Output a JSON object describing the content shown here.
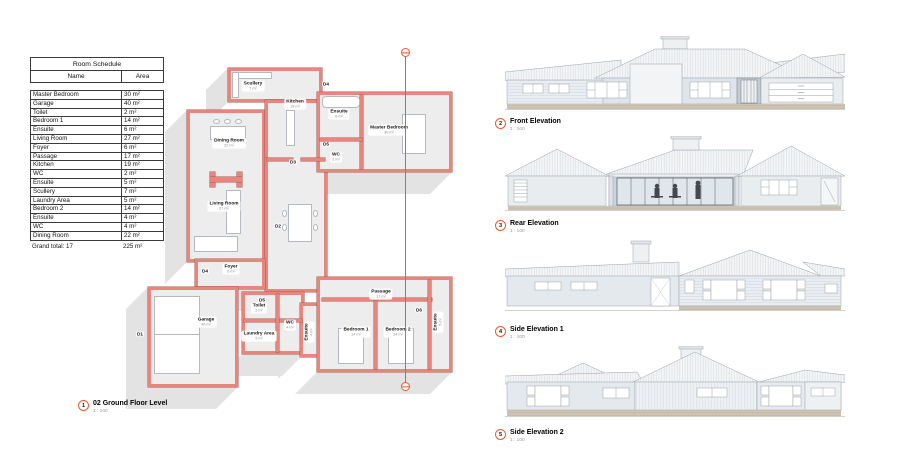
{
  "colors": {
    "accent": "#f05a28",
    "plan_wall": "#e8857c",
    "plan_wall_edge": "#a35a52",
    "plan_floor": "#ededed",
    "shadow": "#e3e3e3",
    "elevation_wall": "#e2e8ed",
    "plinth": "#cec4b4"
  },
  "schedule": {
    "title": "Room Schedule",
    "columns": [
      "Name",
      "Area"
    ],
    "rows": [
      [
        "Master Bedroom",
        "30 m²"
      ],
      [
        "Garage",
        "40 m²"
      ],
      [
        "Toilet",
        "2 m²"
      ],
      [
        "Bedroom 1",
        "14 m²"
      ],
      [
        "Ensuite",
        "6 m²"
      ],
      [
        "Living Room",
        "27 m²"
      ],
      [
        "Foyer",
        "6 m²"
      ],
      [
        "Passage",
        "17 m²"
      ],
      [
        "Kitchen",
        "19 m²"
      ],
      [
        "WC",
        "2 m²"
      ],
      [
        "Ensuite",
        "5 m²"
      ],
      [
        "Scullery",
        "7 m²"
      ],
      [
        "Laundry Area",
        "5 m²"
      ],
      [
        "Bedroom 2",
        "14 m²"
      ],
      [
        "Ensuite",
        "4 m²"
      ],
      [
        "WC",
        "4 m²"
      ],
      [
        "Dining Room",
        "22 m²"
      ]
    ],
    "total_label": "Grand total: 17",
    "total_value": "225 m²"
  },
  "plan": {
    "number": "1",
    "title": "02 Ground Floor Level",
    "scale": "1 : 100",
    "room_labels": [
      {
        "name": "Scullery",
        "area": "7 m²",
        "x": 253,
        "y": 86,
        "rot": 0
      },
      {
        "name": "Kitchen",
        "area": "19 m²",
        "x": 295,
        "y": 104,
        "rot": 0
      },
      {
        "name": "Ensuite",
        "area": "6 m²",
        "x": 339,
        "y": 114,
        "rot": 0
      },
      {
        "name": "Master Bedroom",
        "area": "30 m²",
        "x": 389,
        "y": 130,
        "rot": 0
      },
      {
        "name": "WC",
        "area": "2 m²",
        "x": 336,
        "y": 157,
        "rot": 0
      },
      {
        "name": "Dining Room",
        "area": "22 m²",
        "x": 229,
        "y": 143,
        "rot": 0
      },
      {
        "name": "Living Room",
        "area": "27 m²",
        "x": 224,
        "y": 206,
        "rot": 0
      },
      {
        "name": "Foyer",
        "area": "6 m²",
        "x": 231,
        "y": 269,
        "rot": 0
      },
      {
        "name": "Garage",
        "area": "40 m²",
        "x": 206,
        "y": 322,
        "rot": 0
      },
      {
        "name": "Toilet",
        "area": "2 m²",
        "x": 259,
        "y": 308,
        "rot": 0
      },
      {
        "name": "WC",
        "area": "4 m²",
        "x": 290,
        "y": 325,
        "rot": 0
      },
      {
        "name": "Laundry Area",
        "area": "5 m²",
        "x": 259,
        "y": 336,
        "rot": 0
      },
      {
        "name": "Ensuite",
        "area": "4 m²",
        "x": 309,
        "y": 332,
        "rot": 1
      },
      {
        "name": "Passage",
        "area": "17 m²",
        "x": 381,
        "y": 294,
        "rot": 0
      },
      {
        "name": "Bedroom 1",
        "area": "14 m²",
        "x": 356,
        "y": 332,
        "rot": 0
      },
      {
        "name": "Bedroom 2",
        "area": "14 m²",
        "x": 398,
        "y": 332,
        "rot": 0
      },
      {
        "name": "Ensuite",
        "area": "5 m²",
        "x": 438,
        "y": 322,
        "rot": 1
      }
    ],
    "door_labels": [
      {
        "label": "D1",
        "x": 140,
        "y": 334
      },
      {
        "label": "D2",
        "x": 278,
        "y": 226
      },
      {
        "label": "D3",
        "x": 293,
        "y": 162
      },
      {
        "label": "D4",
        "x": 326,
        "y": 84
      },
      {
        "label": "D4",
        "x": 205,
        "y": 271
      },
      {
        "label": "D5",
        "x": 326,
        "y": 144
      },
      {
        "label": "D5",
        "x": 262,
        "y": 300
      },
      {
        "label": "D6",
        "x": 419,
        "y": 310
      }
    ]
  },
  "elevations": [
    {
      "number": "2",
      "title": "Front Elevation",
      "scale": "1 : 100"
    },
    {
      "number": "3",
      "title": "Rear Elevation",
      "scale": "1 : 100"
    },
    {
      "number": "4",
      "title": "Side Elevation 1",
      "scale": "1 : 100"
    },
    {
      "number": "5",
      "title": "Side Elevation 2",
      "scale": "1 : 100"
    }
  ]
}
